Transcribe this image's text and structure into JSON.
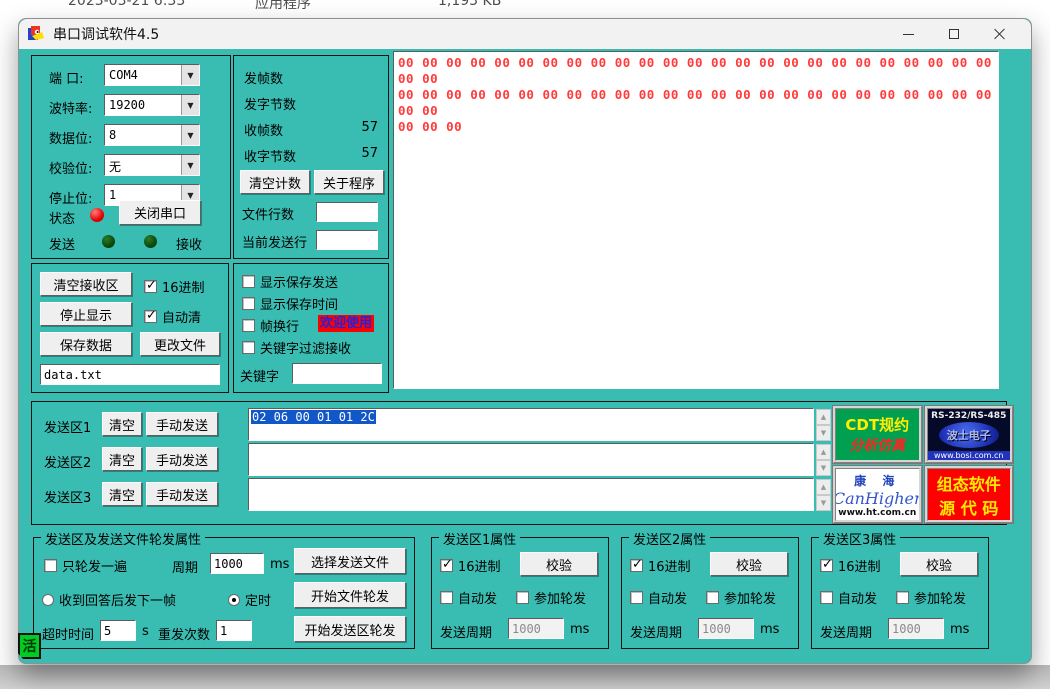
{
  "explorer": {
    "date": "2023-03-21 6:33",
    "type": "应用程序",
    "size": "1,193 KB"
  },
  "window": {
    "title": "串口调试软件4.5"
  },
  "settings": {
    "port_label": "端  口:",
    "port_value": "COM4",
    "baud_label": "波特率:",
    "baud_value": "19200",
    "data_label": "数据位:",
    "data_value": "8",
    "parity_label": "校验位:",
    "parity_value": "无",
    "stop_label": "停止位:",
    "stop_value": "1",
    "status_label": "状态",
    "close_button": "关闭串口",
    "send_label": "发送",
    "recv_label": "接收"
  },
  "stats": {
    "sent_frames_label": "发帧数",
    "sent_frames_value": "",
    "sent_bytes_label": "发字节数",
    "sent_bytes_value": "",
    "recv_frames_label": "收帧数",
    "recv_frames_value": "57",
    "recv_bytes_label": "收字节数",
    "recv_bytes_value": "57",
    "clear_count_button": "清空计数",
    "about_button": "关于程序",
    "file_lines_label": "文件行数",
    "file_lines_value": "",
    "current_line_label": "当前发送行",
    "current_line_value": ""
  },
  "receive": {
    "lines": [
      "00 00 00 00 00 00 00 00 00 00 00 00 00 00 00 00 00 00 00 00 00 00 00 00 00 00 00",
      "00 00 00 00 00 00 00 00 00 00 00 00 00 00 00 00 00 00 00 00 00 00 00 00 00 00 00",
      "00 00 00"
    ]
  },
  "recv_ctrl": {
    "clear_recv_button": "清空接收区",
    "hex_checkbox": "16进制",
    "stop_display_button": "停止显示",
    "autoclear_checkbox": "自动清",
    "save_data_button": "保存数据",
    "change_file_button": "更改文件",
    "filename_value": "data.txt"
  },
  "display_opts": {
    "cb_show_send": "显示保存发送",
    "cb_show_time": "显示保存时间",
    "cb_frame_wrap": "帧换行",
    "welcome_badge": "欢迎使用",
    "cb_keyword_filter": "关键字过滤接收",
    "keyword_label": "关键字",
    "keyword_value": ""
  },
  "send_rows": [
    {
      "label": "发送区1",
      "clear_button": "清空",
      "manual_button": "手动发送",
      "value": "02 06 00 01 01 2C"
    },
    {
      "label": "发送区2",
      "clear_button": "清空",
      "manual_button": "手动发送",
      "value": ""
    },
    {
      "label": "发送区3",
      "clear_button": "清空",
      "manual_button": "手动发送",
      "value": ""
    }
  ],
  "logos": {
    "cdt": {
      "line1": "CDT规约",
      "line2": "分析仿真"
    },
    "bosi": {
      "line1": "RS-232/RS-485",
      "line2": "波士电子",
      "line3": "www.bosi.com.cn"
    },
    "canhigher": {
      "line1": "康 海",
      "line2": "CanHigher",
      "line3": "www.ht.com.cn"
    },
    "scada": {
      "line1": "组态软件",
      "line2": "源 代 码"
    }
  },
  "cycle_panel": {
    "title": "发送区及发送文件轮发属性",
    "once_checkbox": "只轮发一遍",
    "period_label": "周期",
    "period_value": "1000",
    "ms_label": "ms",
    "radio_answer": "收到回答后发下一帧",
    "radio_timer": "定时",
    "timeout_label": "超时时间",
    "timeout_value": "5",
    "s_label": "s",
    "retry_label": "重发次数",
    "retry_value": "1",
    "select_file_button": "选择发送文件",
    "start_file_button": "开始文件轮发",
    "start_area_button": "开始发送区轮发"
  },
  "area_props": [
    {
      "title": "发送区1属性",
      "hex_checkbox": "16进制",
      "verify_button": "校验",
      "auto_checkbox": "自动发",
      "join_checkbox": "参加轮发",
      "period_label": "发送周期",
      "period_value": "1000",
      "ms_label": "ms"
    },
    {
      "title": "发送区2属性",
      "hex_checkbox": "16进制",
      "verify_button": "校验",
      "auto_checkbox": "自动发",
      "join_checkbox": "参加轮发",
      "period_label": "发送周期",
      "period_value": "1000",
      "ms_label": "ms"
    },
    {
      "title": "发送区3属性",
      "hex_checkbox": "16进制",
      "verify_button": "校验",
      "auto_checkbox": "自动发",
      "join_checkbox": "参加轮发",
      "period_label": "发送周期",
      "period_value": "1000",
      "ms_label": "ms"
    }
  ],
  "ime_badge": "活",
  "colors": {
    "window_bg": "#39bcb1",
    "hex_text": "#ff3b3b",
    "selection": "#1257c8",
    "welcome_bg": "#ff0000"
  }
}
